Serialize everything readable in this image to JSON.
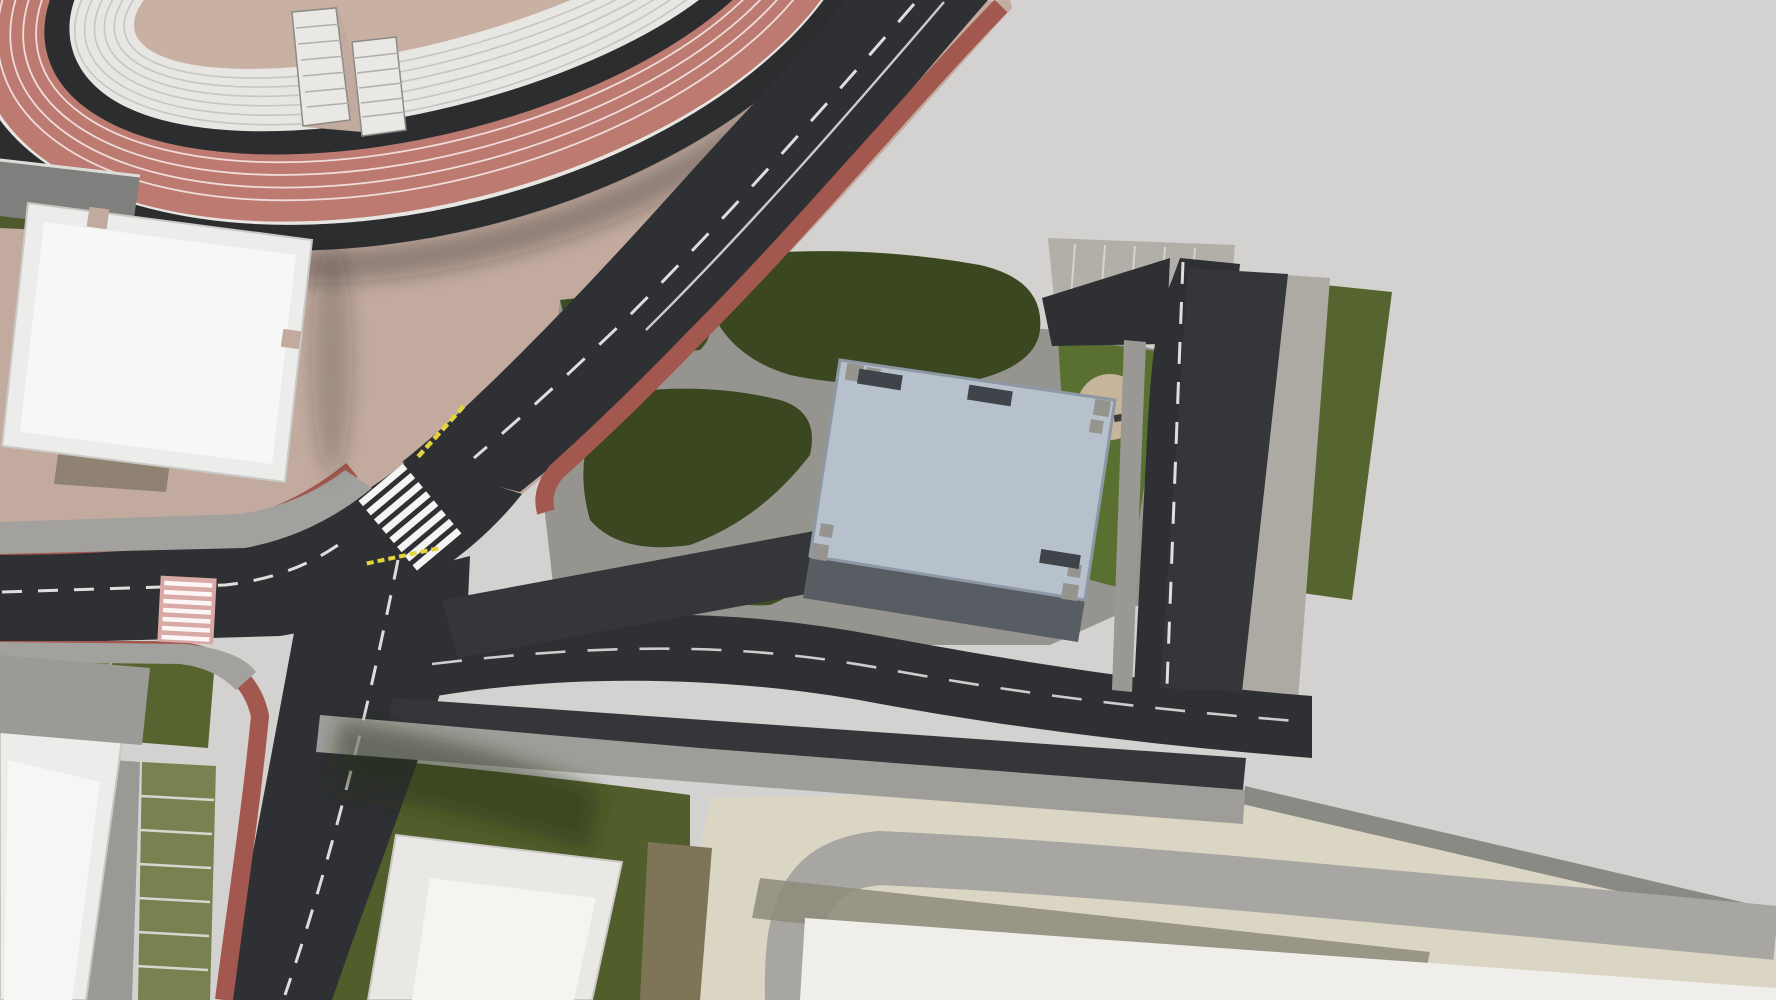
{
  "scene": {
    "type": "aerial-3d-site-render",
    "description": "Bird's-eye render: athletics stadium with red track, tan plaza with cafe tables, asphalt roads with red bike lanes, parking rows, office building with rooftop solar panels, concrete esplanade with trees"
  },
  "palette": {
    "asphalt": "#2f3033",
    "asphalt_light": "#3a3b3e",
    "track_red": "#bd7a70",
    "bike_red": "#a2584e",
    "plaza_tan": "#c2aa9e",
    "field_tan": "#c8b1a3",
    "concrete": "#d3d2d0",
    "beige": "#dbd6c4",
    "gray_band": "#a7a6a3",
    "sidewalk": "#a3a19d",
    "paver": "#b4b1ab",
    "lawn_olive": "#515e2b",
    "lawn_dark": "#3a4720",
    "grass_paver": "#7a8150",
    "roof_blue": "#b7c1cb",
    "roof_edge": "#8d98a4",
    "wall": "#575d63",
    "white_bldg": "#efeeeb",
    "steps_white": "#e7e6e3",
    "solar": "#383c42",
    "cube_white": "#f2f1ee",
    "table_gray": "#8f8e8a",
    "chair_orange": "#cf5c28",
    "marking_white": "#f2f2f0",
    "marking_yellow": "#e3d33c",
    "pink_cross": "#d9a9a5",
    "person": "#2e2d2b",
    "car_colors": {
      "white": "#e9e9e7",
      "black": "#16171b",
      "navy": "#1f2a45",
      "gray": "#80848a",
      "red": "#ad1b24",
      "green": "#1e5a30",
      "yellow": "#c9a43a",
      "dark": "#26272c"
    }
  },
  "stadium": {
    "track_lanes": 5,
    "seating_step_rings": 6,
    "entrance_stairs": 2
  },
  "building": {
    "solar_panels": [
      [
        1007,
        452
      ],
      [
        1039,
        450
      ],
      [
        1023,
        498
      ],
      [
        1052,
        498
      ],
      [
        1036,
        550
      ],
      [
        1072,
        555
      ],
      [
        1044,
        588
      ]
    ],
    "solar_size": [
      24,
      40
    ],
    "solar_rot": 32,
    "roof_cube": [
      958,
      492
    ],
    "skylight": [
      1088,
      505
    ]
  },
  "vehicles": [
    {
      "x": 536,
      "y": 621,
      "rot": 79,
      "color": "white",
      "kind": "car"
    },
    {
      "x": 568,
      "y": 615,
      "rot": 79,
      "color": "white",
      "kind": "car"
    },
    {
      "x": 663,
      "y": 596,
      "rot": 79,
      "color": "navy",
      "kind": "car"
    },
    {
      "x": 695,
      "y": 590,
      "rot": 79,
      "color": "white",
      "kind": "car"
    },
    {
      "x": 790,
      "y": 571,
      "rot": 79,
      "color": "navy",
      "kind": "car"
    },
    {
      "x": 822,
      "y": 565,
      "rot": 79,
      "color": "white",
      "kind": "car"
    },
    {
      "x": 1209,
      "y": 323,
      "rot": 186,
      "color": "navy",
      "kind": "car"
    },
    {
      "x": 1205,
      "y": 361,
      "rot": 186,
      "color": "yellow",
      "kind": "car"
    },
    {
      "x": 1196,
      "y": 437,
      "rot": 186,
      "color": "white",
      "kind": "car"
    },
    {
      "x": 1191,
      "y": 475,
      "rot": 186,
      "color": "yellow",
      "kind": "car"
    },
    {
      "x": 1187,
      "y": 513,
      "rot": 186,
      "color": "navy",
      "kind": "car"
    },
    {
      "x": 1182,
      "y": 551,
      "rot": 186,
      "color": "navy",
      "kind": "car"
    },
    {
      "x": 1178,
      "y": 589,
      "rot": 186,
      "color": "green",
      "kind": "car"
    },
    {
      "x": 1173,
      "y": 627,
      "rot": 186,
      "color": "white",
      "kind": "car"
    },
    {
      "x": 1169,
      "y": 665,
      "rot": 186,
      "color": "white",
      "kind": "car"
    },
    {
      "x": 1258,
      "y": 285,
      "rot": 6,
      "color": "black",
      "kind": "van"
    },
    {
      "x": 1249,
      "y": 361,
      "rot": 6,
      "color": "navy",
      "kind": "car"
    },
    {
      "x": 1244,
      "y": 399,
      "rot": 6,
      "color": "navy",
      "kind": "car"
    },
    {
      "x": 1240,
      "y": 437,
      "rot": 6,
      "color": "navy",
      "kind": "car"
    },
    {
      "x": 1226,
      "y": 551,
      "rot": 6,
      "color": "navy",
      "kind": "car"
    },
    {
      "x": 1222,
      "y": 589,
      "rot": 6,
      "color": "navy",
      "kind": "car"
    },
    {
      "x": 1217,
      "y": 627,
      "rot": 6,
      "color": "navy",
      "kind": "car"
    },
    {
      "x": 1213,
      "y": 665,
      "rot": 6,
      "color": "navy",
      "kind": "car"
    },
    {
      "x": 525,
      "y": 756,
      "rot": 96,
      "color": "white",
      "kind": "car"
    },
    {
      "x": 557,
      "y": 757,
      "rot": 96,
      "color": "white",
      "kind": "car"
    },
    {
      "x": 655,
      "y": 762,
      "rot": 96,
      "color": "white",
      "kind": "van"
    },
    {
      "x": 690,
      "y": 764,
      "rot": 96,
      "color": "black",
      "kind": "car"
    },
    {
      "x": 760,
      "y": 767,
      "rot": 96,
      "color": "gray",
      "kind": "car"
    },
    {
      "x": 792,
      "y": 768,
      "rot": 96,
      "color": "white",
      "kind": "car"
    },
    {
      "x": 828,
      "y": 770,
      "rot": 96,
      "color": "navy",
      "kind": "car"
    },
    {
      "x": 915,
      "y": 774,
      "rot": 96,
      "color": "white",
      "kind": "car"
    },
    {
      "x": 1020,
      "y": 778,
      "rot": 96,
      "color": "white",
      "kind": "car"
    },
    {
      "x": 1056,
      "y": 780,
      "rot": 96,
      "color": "red",
      "kind": "car"
    },
    {
      "x": 1090,
      "y": 781,
      "rot": 96,
      "color": "green",
      "kind": "car"
    },
    {
      "x": 1125,
      "y": 783,
      "rot": 96,
      "color": "navy",
      "kind": "car"
    },
    {
      "x": 1186,
      "y": 786,
      "rot": 96,
      "color": "white",
      "kind": "van"
    },
    {
      "x": 1218,
      "y": 787,
      "rot": 96,
      "color": "black",
      "kind": "car"
    },
    {
      "x": 383,
      "y": 612,
      "rot": 100,
      "color": "white",
      "kind": "car"
    },
    {
      "x": 865,
      "y": 172,
      "rot": 134,
      "color": "navy",
      "kind": "car"
    },
    {
      "x": 549,
      "y": 317,
      "rot": 132,
      "color": "white",
      "kind": "car"
    },
    {
      "x": 748,
      "y": 130,
      "rot": -46,
      "color": "black",
      "kind": "car"
    },
    {
      "x": 561,
      "y": 341,
      "rot": 132,
      "color": "dark",
      "kind": "moto"
    }
  ],
  "stall_pads": [
    [
      472,
      633,
      30,
      60,
      -11
    ],
    [
      504,
      627,
      30,
      60,
      -11
    ],
    [
      599,
      608,
      30,
      60,
      -11
    ],
    [
      631,
      602,
      30,
      60,
      -11
    ],
    [
      726,
      584,
      30,
      60,
      -11
    ],
    [
      758,
      578,
      30,
      60,
      -11
    ],
    [
      1214,
      285,
      46,
      30,
      6
    ],
    [
      1253,
      323,
      46,
      30,
      6
    ],
    [
      1200,
      399,
      46,
      30,
      6
    ],
    [
      1235,
      475,
      46,
      30,
      6
    ],
    [
      1231,
      513,
      46,
      30,
      6
    ],
    [
      592,
      759,
      30,
      52,
      6
    ],
    [
      624,
      761,
      30,
      52,
      6
    ],
    [
      725,
      766,
      30,
      52,
      6
    ],
    [
      860,
      772,
      30,
      52,
      6
    ],
    [
      948,
      776,
      30,
      52,
      6
    ],
    [
      984,
      778,
      30,
      52,
      6
    ],
    [
      1155,
      784,
      30,
      52,
      6
    ],
    [
      1010,
      290,
      28,
      54,
      8
    ],
    [
      1044,
      296,
      28,
      54,
      8
    ],
    [
      1078,
      302,
      28,
      54,
      8
    ],
    [
      1112,
      308,
      28,
      54,
      8
    ],
    [
      1146,
      314,
      28,
      54,
      8
    ]
  ],
  "trees": [
    [
      902,
      92,
      46,
      "d"
    ],
    [
      968,
      62,
      40,
      "d"
    ],
    [
      1040,
      142,
      50,
      "d"
    ],
    [
      1102,
      92,
      42,
      "d"
    ],
    [
      998,
      222,
      52,
      "d"
    ],
    [
      1100,
      238,
      46,
      "d"
    ],
    [
      938,
      172,
      40,
      "d"
    ],
    [
      1168,
      48,
      46,
      "d"
    ],
    [
      1222,
      122,
      52,
      "d"
    ],
    [
      1190,
      258,
      48,
      "d"
    ],
    [
      1248,
      312,
      42,
      "d"
    ],
    [
      1210,
      180,
      44,
      "d"
    ],
    [
      988,
      266,
      40,
      "d"
    ],
    [
      930,
      300,
      30,
      "d"
    ],
    [
      12,
      178,
      18,
      "d"
    ],
    [
      1422,
      162,
      40,
      "m"
    ],
    [
      1478,
      270,
      46,
      "d"
    ],
    [
      1548,
      345,
      44,
      "m"
    ],
    [
      1608,
      420,
      34,
      "m"
    ],
    [
      1282,
      592,
      36,
      "m"
    ],
    [
      1320,
      560,
      24,
      "m"
    ],
    [
      641,
      447,
      22,
      "m"
    ],
    [
      1306,
      80,
      44,
      "b"
    ],
    [
      1302,
      352,
      30,
      "b"
    ],
    [
      1342,
      424,
      26,
      "b"
    ],
    [
      694,
      486,
      30,
      "b"
    ],
    [
      8,
      30,
      28,
      "b"
    ],
    [
      1762,
      452,
      26,
      "b"
    ],
    [
      1118,
      524,
      20,
      "b"
    ],
    [
      1146,
      564,
      18,
      "b"
    ]
  ],
  "tree_shadows": [
    [
      1490,
      248,
      135,
      90
    ],
    [
      1545,
      68,
      62,
      40
    ],
    [
      1392,
      132,
      56,
      36
    ],
    [
      1300,
      268,
      48,
      30
    ],
    [
      1652,
      372,
      62,
      40
    ],
    [
      1598,
      200,
      48,
      32
    ],
    [
      1352,
      330,
      42,
      26
    ],
    [
      1395,
      402,
      34,
      22
    ],
    [
      1700,
      470,
      40,
      26
    ],
    [
      1262,
      158,
      48,
      80
    ],
    [
      1430,
      470,
      60,
      36
    ]
  ],
  "bushes": [
    [
      948,
      180,
      26
    ],
    [
      876,
      272,
      30
    ],
    [
      742,
      440,
      30
    ],
    [
      592,
      534,
      34
    ],
    [
      700,
      398,
      20
    ],
    [
      648,
      372,
      16
    ]
  ],
  "tables": [
    [
      250,
      247
    ],
    [
      333,
      248
    ],
    [
      395,
      240
    ],
    [
      262,
      300
    ],
    [
      345,
      305
    ],
    [
      428,
      318
    ],
    [
      258,
      355
    ],
    [
      338,
      360
    ],
    [
      460,
      322
    ],
    [
      490,
      305
    ],
    [
      540,
      250
    ],
    [
      590,
      292
    ]
  ],
  "people": [
    [
      400,
      15
    ],
    [
      455,
      30
    ],
    [
      520,
      8
    ],
    [
      600,
      28
    ],
    [
      380,
      55
    ],
    [
      650,
      45
    ],
    [
      570,
      62
    ],
    [
      480,
      40
    ],
    [
      565,
      58
    ],
    [
      582,
      66
    ],
    [
      597,
      58
    ],
    [
      612,
      66
    ],
    [
      576,
      78
    ],
    [
      601,
      80
    ],
    [
      562,
      90
    ],
    [
      590,
      95
    ],
    [
      621,
      88
    ],
    [
      230,
      8
    ],
    [
      300,
      40
    ],
    [
      262,
      215
    ],
    [
      300,
      238
    ],
    [
      360,
      255
    ],
    [
      418,
      270
    ],
    [
      455,
      300
    ],
    [
      500,
      330
    ],
    [
      545,
      345
    ],
    [
      420,
      330
    ],
    [
      350,
      330
    ],
    [
      310,
      300
    ],
    [
      475,
      260
    ],
    [
      560,
      310
    ],
    [
      612,
      330
    ],
    [
      642,
      300
    ],
    [
      685,
      210
    ],
    [
      715,
      170
    ],
    [
      452,
      332
    ],
    [
      470,
      345
    ],
    [
      1000,
      318
    ],
    [
      1028,
      330
    ],
    [
      968,
      308
    ],
    [
      757,
      345
    ],
    [
      790,
      357
    ]
  ],
  "bollard_rows": [
    [
      388,
      360,
      604,
      243,
      11
    ],
    [
      248,
      452,
      336,
      398,
      6
    ],
    [
      618,
      240,
      690,
      184,
      4
    ]
  ],
  "lamps": [
    [
      440,
      489
    ],
    [
      262,
      509
    ],
    [
      700,
      172
    ],
    [
      1245,
      842
    ],
    [
      776,
      338
    ]
  ],
  "road_arrows": [
    [
      480,
      662,
      270,
      "solid"
    ],
    [
      474,
      699,
      90,
      "solid"
    ],
    [
      872,
      649,
      272,
      "solid"
    ],
    [
      872,
      684,
      92,
      "solid"
    ],
    [
      1298,
      712,
      272,
      "solid"
    ],
    [
      1297,
      747,
      92,
      "faint"
    ],
    [
      455,
      398,
      212,
      "combo"
    ],
    [
      524,
      421,
      34,
      "solid"
    ],
    [
      1186,
      456,
      2,
      "solid"
    ],
    [
      1157,
      506,
      270,
      "small"
    ],
    [
      1616,
      128,
      0,
      "faint"
    ],
    [
      1650,
      128,
      0,
      "faint"
    ],
    [
      1692,
      718,
      0,
      "faint"
    ],
    [
      1630,
      808,
      270,
      "faint"
    ],
    [
      1648,
      842,
      90,
      "faint"
    ]
  ]
}
